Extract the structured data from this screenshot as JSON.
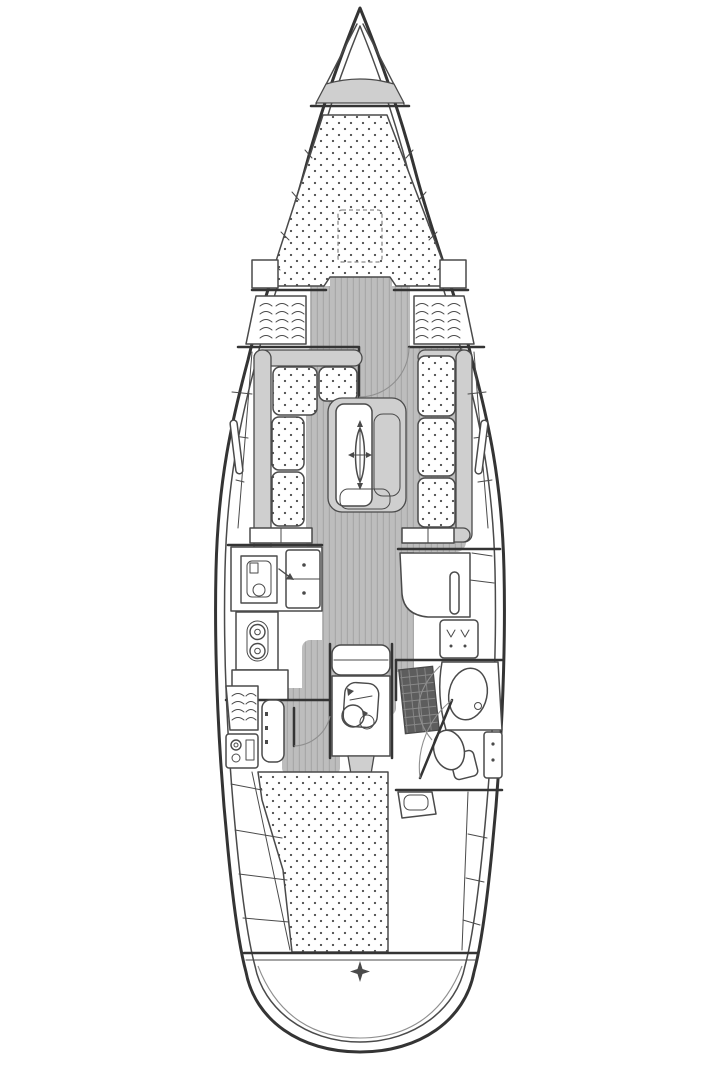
{
  "meta": {
    "type": "sailing-yacht-interior-floorplan",
    "orientation": "bow-up",
    "visible_text": "none"
  },
  "colors": {
    "paper": "#ffffff",
    "line": "#4a4a4a",
    "lineHeavy": "#343434",
    "lineSoft": "#8c8c8c",
    "arc": "#8f8f8f",
    "sole": "#bdbdbd",
    "soleLine": "#a8a8a8",
    "furn": "#cfcfcf",
    "grate": "#5d5d5d",
    "grateLine": "#888888",
    "dot": "#4f4f4f"
  },
  "fixtures": [
    "anchor-locker",
    "v-berth-double-bed",
    "deck-hatch",
    "hanging-locker-port",
    "hanging-locker-starboard",
    "forward-cabin-door",
    "l-shaped-settee-port",
    "straight-settee-starboard",
    "saloon-table",
    "mast-symbol",
    "galley-oven",
    "galley-double-sink",
    "galley-stove-burners",
    "galley-fridge-counter",
    "nav-desk",
    "nav-seat",
    "heads-shower-grate",
    "heads-washbasin",
    "heads-toilet",
    "heads-cabinet",
    "heads-door",
    "companionway-steps",
    "engine",
    "propeller-shaft",
    "aft-cabin-door",
    "aft-cabin-hanging-locker",
    "aft-cabin-vanity",
    "aft-cabin-step-seat",
    "aft-double-bed",
    "aft-cabin-seat-starboard",
    "rudder-post-symbol"
  ]
}
